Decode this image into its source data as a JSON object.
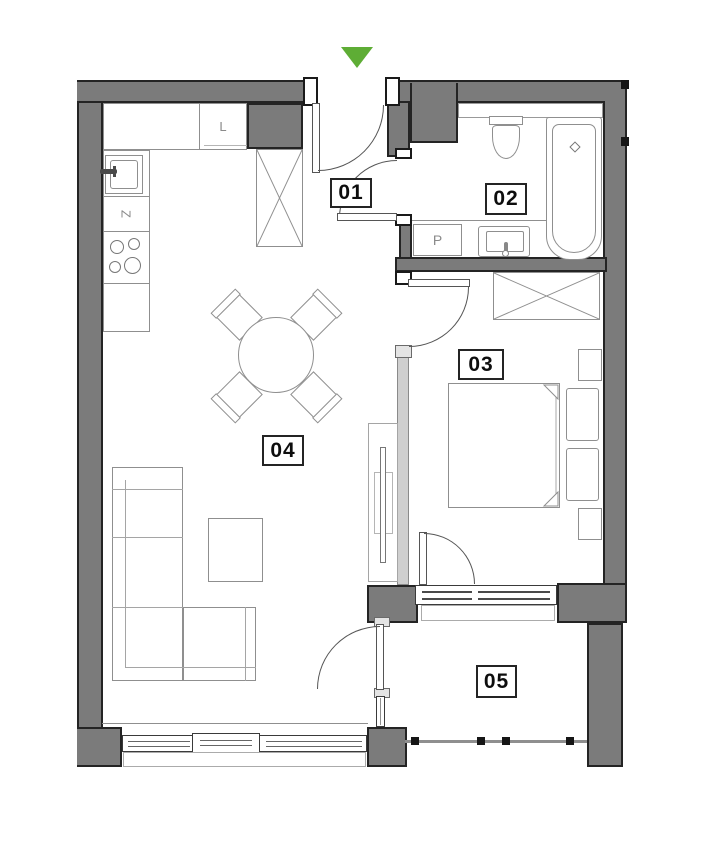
{
  "plan": {
    "title": "apartment-floor-plan",
    "entrance": {
      "marker_icon": "down-arrow"
    },
    "rooms": [
      {
        "id": "01"
      },
      {
        "id": "02"
      },
      {
        "id": "03"
      },
      {
        "id": "04"
      },
      {
        "id": "05"
      }
    ],
    "fixture_labels": {
      "fridge": "L",
      "dishwasher": "Z",
      "washer": "P"
    }
  },
  "colors": {
    "wall": "#7b7b7b",
    "partition": "#cfcfcf",
    "outline": "#242424",
    "furniture_line": "#8f8f8f",
    "accent_green": "#5ead35"
  }
}
